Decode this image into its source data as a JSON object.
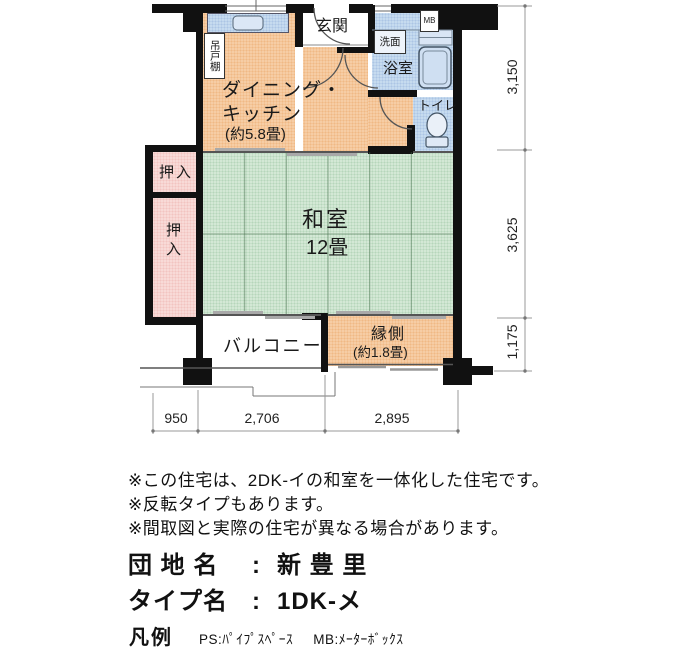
{
  "plan": {
    "rooms": {
      "dining_kitchen": {
        "line1": "ダイニング・",
        "line2": "キッチン",
        "size": "(約5.8畳)"
      },
      "washitsu": {
        "name": "和室",
        "size": "12畳"
      },
      "genkan": {
        "name": "玄関"
      },
      "bathroom": {
        "name": "浴室"
      },
      "washstand": {
        "name": "洗面"
      },
      "toilet": {
        "name": "トイレ"
      },
      "meter_box": {
        "name": "MB"
      },
      "hanging_cupboard": {
        "name": "吊戸棚"
      },
      "closet_upper": {
        "name": "押入"
      },
      "closet_lower": {
        "name": "押入"
      },
      "balcony": {
        "name": "バルコニー"
      },
      "engawa": {
        "name": "縁側",
        "size": "(約1.8畳)"
      }
    },
    "dimensions": {
      "bottom": [
        "950",
        "2,706",
        "2,895"
      ],
      "right": [
        "3,150",
        "3,625",
        "1,175"
      ]
    }
  },
  "notes": [
    "※この住宅は、2DK-イの和室を一体化した住宅です。",
    "※反転タイプもあります。",
    "※間取図と実際の住宅が異なる場合があります。"
  ],
  "info": {
    "danchi_label": "団 地 名",
    "danchi_sep": ":",
    "danchi_value": "新 豊 里",
    "type_label": "タイプ名",
    "type_sep": ":",
    "type_value": "1DK-メ"
  },
  "legend": {
    "title": "凡例",
    "ps": "PS:ﾊﾟｲﾌﾟｽﾍﾟｰｽ",
    "mb": "MB:ﾒｰﾀｰﾎﾞｯｸｽ"
  },
  "colors": {
    "room_peach": "#f6cda5",
    "tatami_green": "#d3e8d5",
    "wet_area_blue": "#c6dbef",
    "closet_pink": "#f8dad7",
    "wall_black": "#111111"
  }
}
